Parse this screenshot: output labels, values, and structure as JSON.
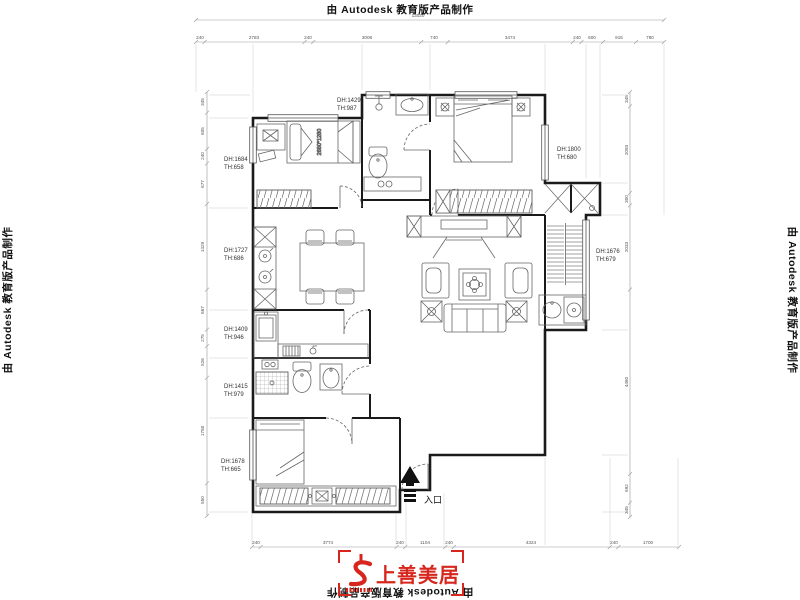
{
  "stamps": {
    "top": "由 Autodesk 教育版产品制作",
    "left": "由 Autodesk 教育版产品制作",
    "right": "由 Autodesk 教育版产品制作",
    "bottom": "由 Autodesk 教育版产品制作"
  },
  "logo": {
    "brand": "上善美居",
    "accent_color": "#d6261d"
  },
  "plan": {
    "entrance_label": "入口",
    "bed_size_label": "2680*1280",
    "room_tags": [
      {
        "dh": "DH:1684",
        "th": "TH:658"
      },
      {
        "dh": "DH:1429",
        "th": "TH:987"
      },
      {
        "dh": "DH:1800",
        "th": "TH:680"
      },
      {
        "dh": "DH:1676",
        "th": "TH:679"
      },
      {
        "dh": "DH:1727",
        "th": "TH:686"
      },
      {
        "dh": "DH:1409",
        "th": "TH:946"
      },
      {
        "dh": "DH:1415",
        "th": "TH:979"
      },
      {
        "dh": "DH:1678",
        "th": "TH:665"
      }
    ],
    "dims": {
      "top_total": "13020",
      "top": [
        "240",
        "2783",
        "240",
        "3008",
        "740",
        "3474",
        "240",
        "600",
        "915",
        "780"
      ],
      "bottom": [
        "240",
        "3774",
        "240",
        "1104",
        "240",
        "4324",
        "240",
        "1700"
      ],
      "left": [
        "345",
        "605",
        "240",
        "677",
        "1429",
        "667",
        "275",
        "526",
        "1758",
        "550"
      ],
      "right": [
        "345",
        "2093",
        "300",
        "2033",
        "4460",
        "692",
        "345"
      ]
    }
  }
}
